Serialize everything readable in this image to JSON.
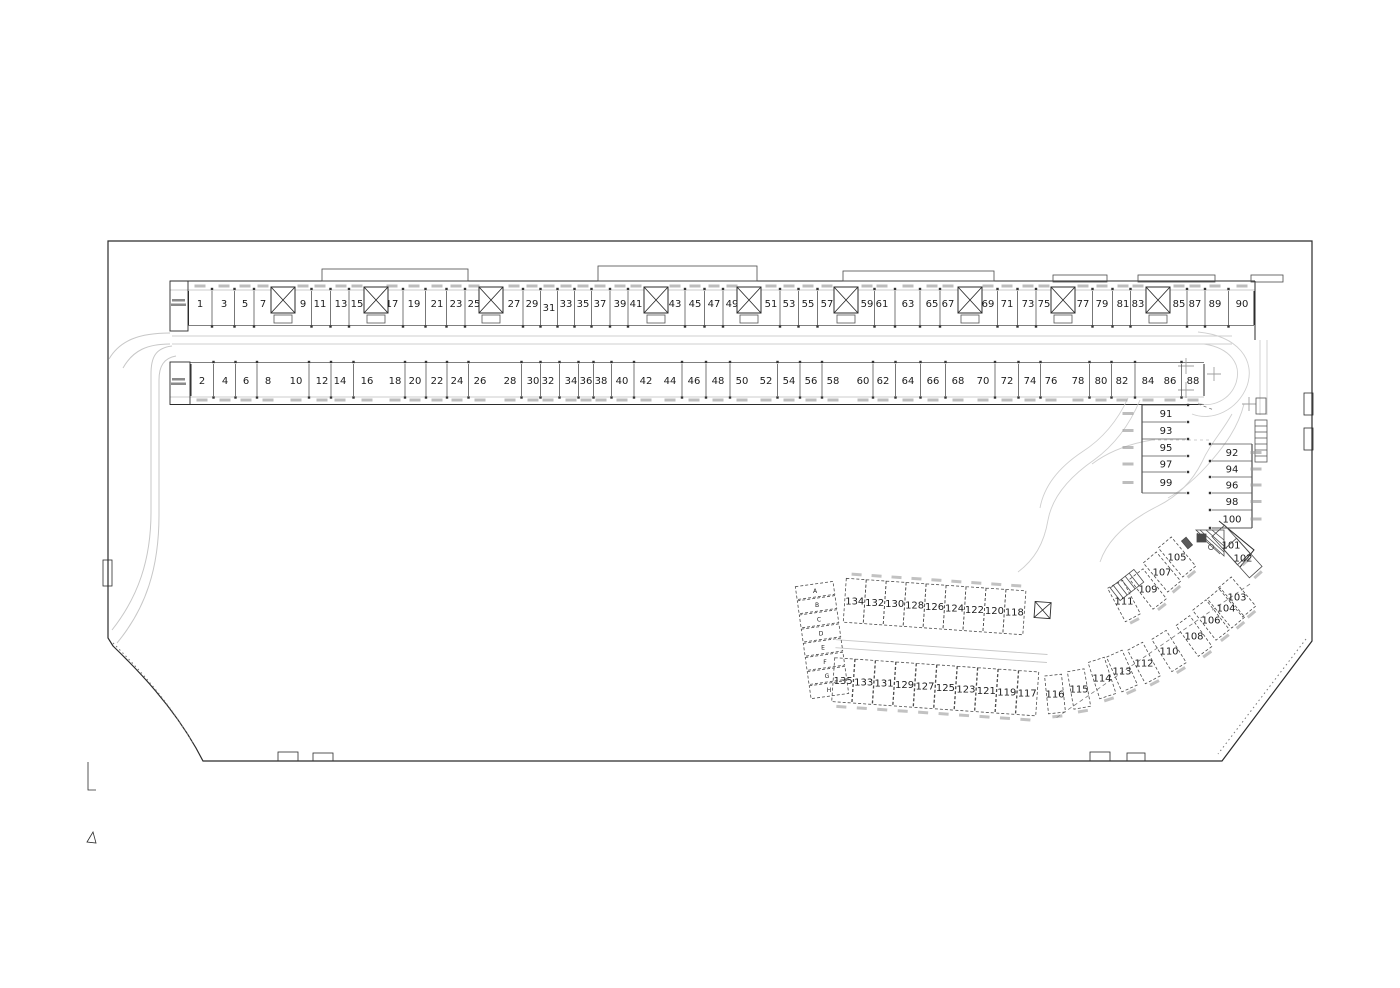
{
  "plan": {
    "type": "parking-garage-floor-plan",
    "colors": {
      "line": "#2b2b2b",
      "thin": "#555555",
      "faint": "#c7c7c7",
      "tag": "#9a9a9a",
      "text": "#1c1c1c",
      "dash": "#4a4a4a"
    },
    "top_row": {
      "y_number": 307,
      "y_body": [
        291,
        325
      ],
      "y_tag": 284.5,
      "stalls": [
        [
          1,
          200
        ],
        [
          3,
          224
        ],
        [
          5,
          245
        ],
        [
          7,
          263
        ],
        [
          9,
          303
        ],
        [
          11,
          320
        ],
        [
          13,
          341
        ],
        [
          15,
          357
        ],
        [
          17,
          392
        ],
        [
          19,
          414
        ],
        [
          21,
          437
        ],
        [
          23,
          456
        ],
        [
          25,
          474
        ],
        [
          27,
          514
        ],
        [
          29,
          532
        ],
        [
          31,
          549
        ],
        [
          33,
          566
        ],
        [
          35,
          583
        ],
        [
          37,
          600
        ],
        [
          39,
          620
        ],
        [
          41,
          636
        ],
        [
          43,
          675
        ],
        [
          45,
          695
        ],
        [
          47,
          714
        ],
        [
          49,
          732
        ],
        [
          51,
          771
        ],
        [
          53,
          789
        ],
        [
          55,
          808
        ],
        [
          57,
          827
        ],
        [
          59,
          867
        ],
        [
          61,
          882
        ],
        [
          63,
          908
        ],
        [
          65,
          932
        ],
        [
          67,
          948
        ],
        [
          69,
          988
        ],
        [
          71,
          1007
        ],
        [
          73,
          1028
        ],
        [
          75,
          1044
        ],
        [
          77,
          1083
        ],
        [
          79,
          1102
        ],
        [
          81,
          1123
        ],
        [
          83,
          1138
        ],
        [
          85,
          1179
        ],
        [
          87,
          1195
        ],
        [
          89,
          1215
        ],
        [
          90,
          1242
        ]
      ],
      "caps": [
        188.5,
        1254
      ]
    },
    "shafts_x": [
      283,
      376,
      491,
      656,
      749,
      846,
      970,
      1063,
      1158
    ],
    "bottom_row": {
      "y_number": 384,
      "y_body": [
        364,
        396
      ],
      "y_tag": 398.5,
      "stalls": [
        [
          2,
          202
        ],
        [
          4,
          225
        ],
        [
          6,
          246
        ],
        [
          8,
          268
        ],
        [
          10,
          296
        ],
        [
          12,
          322
        ],
        [
          14,
          340
        ],
        [
          16,
          367
        ],
        [
          18,
          395
        ],
        [
          20,
          415
        ],
        [
          22,
          437
        ],
        [
          24,
          457
        ],
        [
          26,
          480
        ],
        [
          28,
          510
        ],
        [
          30,
          533
        ],
        [
          32,
          548
        ],
        [
          34,
          571
        ],
        [
          36,
          586
        ],
        [
          38,
          601
        ],
        [
          40,
          622
        ],
        [
          42,
          646
        ],
        [
          44,
          670
        ],
        [
          46,
          694
        ],
        [
          48,
          718
        ],
        [
          50,
          742
        ],
        [
          52,
          766
        ],
        [
          54,
          789
        ],
        [
          56,
          811
        ],
        [
          58,
          833
        ],
        [
          60,
          863
        ],
        [
          62,
          883
        ],
        [
          64,
          908
        ],
        [
          66,
          933
        ],
        [
          68,
          958
        ],
        [
          70,
          983
        ],
        [
          72,
          1007
        ],
        [
          74,
          1030
        ],
        [
          76,
          1051
        ],
        [
          78,
          1078
        ],
        [
          80,
          1101
        ],
        [
          82,
          1122
        ],
        [
          84,
          1148
        ],
        [
          86,
          1170
        ],
        [
          88,
          1193
        ]
      ],
      "caps": [
        191,
        1204
      ]
    },
    "stack_a": {
      "x": [
        1142,
        1186
      ],
      "num_x": 1166,
      "tag_x": 1128,
      "edges": [
        405,
        422,
        439,
        456,
        472,
        493
      ],
      "numbers": [
        91,
        93,
        95,
        97,
        99
      ]
    },
    "stack_b": {
      "x": [
        1212,
        1252
      ],
      "num_x": 1232,
      "tag_x": 1256,
      "edges": [
        444,
        461,
        477,
        493,
        510,
        528
      ],
      "numbers": [
        92,
        94,
        96,
        98,
        100
      ]
    },
    "diag_right": [
      [
        101,
        1231,
        545,
        -42
      ],
      [
        102,
        1243,
        558,
        -42
      ],
      [
        103,
        1237,
        597,
        -40
      ],
      [
        104,
        1226,
        608,
        -40
      ],
      [
        106,
        1211,
        620,
        -38
      ],
      [
        108,
        1194,
        636,
        -36
      ],
      [
        110,
        1169,
        651,
        -32
      ],
      [
        112,
        1144,
        663,
        -28
      ],
      [
        113,
        1122,
        671,
        -24
      ],
      [
        114,
        1102,
        678,
        -18
      ],
      [
        115,
        1079,
        689,
        -10
      ],
      [
        116,
        1055,
        694,
        -6
      ]
    ],
    "diag_left": [
      [
        105,
        1177,
        557,
        -40
      ],
      [
        107,
        1162,
        572,
        -40
      ],
      [
        109,
        1148,
        589,
        -38
      ],
      [
        111,
        1124,
        601,
        -28
      ]
    ],
    "lower_block": {
      "rotation": 4,
      "pivot": [
        840,
        640
      ],
      "top_row": {
        "gy_number": 600,
        "g_body": [
          578,
          622
        ],
        "gy_tag": 572,
        "stalls": [
          [
            134,
            852
          ],
          [
            132,
            872
          ],
          [
            130,
            892
          ],
          [
            128,
            912
          ],
          [
            126,
            932
          ],
          [
            124,
            952
          ],
          [
            122,
            972
          ],
          [
            120,
            992
          ],
          [
            118,
            1012
          ]
        ]
      },
      "bottom_row": {
        "gy_number": 680,
        "g_body": [
          658,
          702
        ],
        "gy_tag": 705,
        "stalls": [
          [
            135,
            846
          ],
          [
            133,
            866.5
          ],
          [
            131,
            887
          ],
          [
            129,
            907.5
          ],
          [
            127,
            928
          ],
          [
            125,
            948.5
          ],
          [
            123,
            969
          ],
          [
            121,
            989.5
          ],
          [
            119,
            1010
          ],
          [
            117,
            1030.5
          ]
        ]
      },
      "aisle_gy": [
        640,
        648
      ],
      "aisle_gx": [
        836,
        1048
      ]
    },
    "letters_block": {
      "rotation": -8,
      "pivot": [
        822,
        640
      ],
      "cx": 822,
      "gy_start": 590,
      "gy_step": 14.3,
      "w": 38,
      "h": 13,
      "labels": [
        "A",
        "B",
        "C",
        "D",
        "E",
        "F",
        "G",
        "H"
      ]
    }
  }
}
